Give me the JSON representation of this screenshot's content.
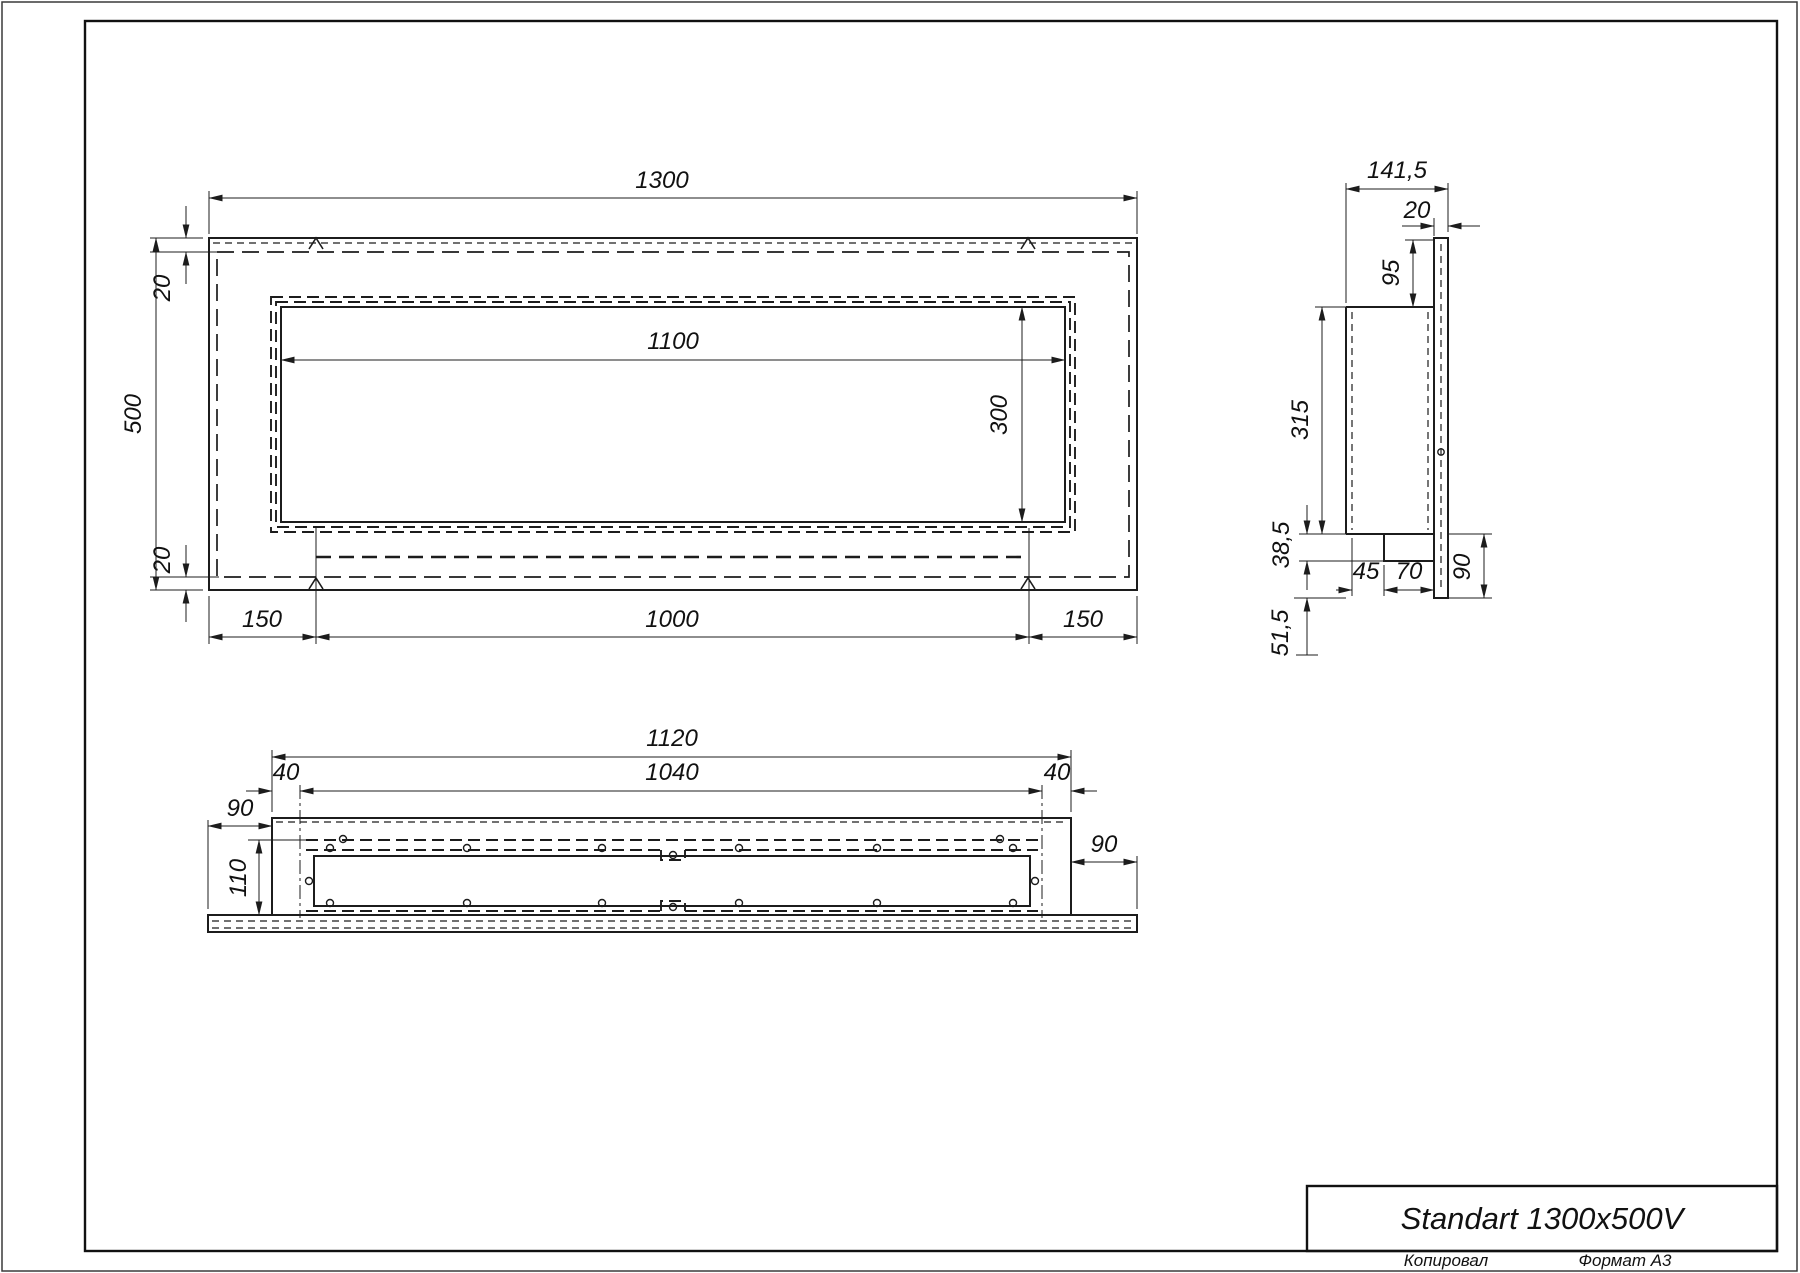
{
  "drawing": {
    "front_view": {
      "overall_width": "1300",
      "top_gap": "20",
      "overall_height": "500",
      "bottom_gap": "20",
      "opening_width": "1100",
      "opening_height": "300",
      "margin_left": "150",
      "inner_width": "1000",
      "margin_right": "150"
    },
    "side_view": {
      "overall_depth": "141,5",
      "wall_thickness": "20",
      "top_offset": "95",
      "body_height": "315",
      "step_height": "38,5",
      "base_depth_a": "45",
      "base_depth_b": "70",
      "wall_drop": "90",
      "bottom_offset": "51,5"
    },
    "bottom_view": {
      "body_width": "1120",
      "inner_width": "1040",
      "end_left": "40",
      "end_right": "40",
      "plate_ext_left": "90",
      "body_depth": "110",
      "plate_ext_right": "90"
    }
  },
  "title_block": {
    "model": "Standart 1300x500V"
  },
  "footer": {
    "copied": "Копировал",
    "format": "Формат А3"
  },
  "colors": {
    "line": "#1c1c1c",
    "paper": "#ffffff"
  }
}
